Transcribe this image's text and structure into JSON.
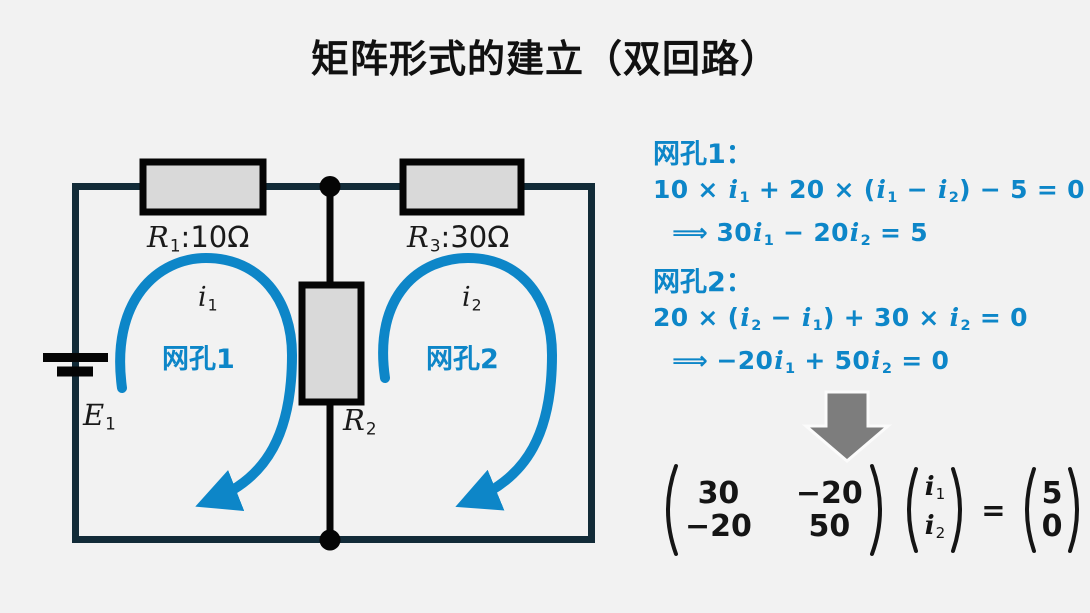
{
  "title": "矩阵形式的建立（双回路）",
  "colors": {
    "background": "#f2f2f2",
    "accent_blue": "#0d86c8",
    "wire_navy": "#122b38",
    "component_fill": "#d9d9d9",
    "ink_black": "#141414",
    "arrow_gray": "#7d7d7d"
  },
  "circuit": {
    "r1_label": [
      {
        "t": "R",
        "s": "rit"
      },
      {
        "t": "1",
        "s": "sub"
      },
      {
        "t": ":10Ω"
      }
    ],
    "r3_label": [
      {
        "t": "R",
        "s": "rit"
      },
      {
        "t": "3",
        "s": "sub"
      },
      {
        "t": ":30Ω"
      }
    ],
    "r2_label": [
      {
        "t": "R",
        "s": "rit"
      },
      {
        "t": "2",
        "s": "sub"
      }
    ],
    "e1_label": [
      {
        "t": "E",
        "s": "rit"
      },
      {
        "t": "1",
        "s": "sub"
      }
    ],
    "mesh1": {
      "current": [
        {
          "t": "i",
          "s": "rit"
        },
        {
          "t": "1",
          "s": "sub"
        }
      ],
      "name": "网孔1"
    },
    "mesh2": {
      "current": [
        {
          "t": "i",
          "s": "rit"
        },
        {
          "t": "2",
          "s": "sub"
        }
      ],
      "name": "网孔2"
    }
  },
  "equations": {
    "mesh1_header": "网孔1：",
    "mesh1_line1": [
      {
        "t": "10 × "
      },
      {
        "t": "i",
        "s": "it"
      },
      {
        "t": "1",
        "s": "sub"
      },
      {
        "t": " + 20 × ("
      },
      {
        "t": "i",
        "s": "it"
      },
      {
        "t": "1",
        "s": "sub"
      },
      {
        "t": " − "
      },
      {
        "t": "i",
        "s": "it"
      },
      {
        "t": "2",
        "s": "sub"
      },
      {
        "t": ") − 5 = 0"
      }
    ],
    "mesh1_line2": [
      {
        "t": "⟹  ",
        "s": "dbl"
      },
      {
        "t": "30"
      },
      {
        "t": "i",
        "s": "it"
      },
      {
        "t": "1",
        "s": "sub"
      },
      {
        "t": " − 20"
      },
      {
        "t": "i",
        "s": "it"
      },
      {
        "t": "2",
        "s": "sub"
      },
      {
        "t": " = 5"
      }
    ],
    "mesh2_header": "网孔2：",
    "mesh2_line1": [
      {
        "t": "20 × ("
      },
      {
        "t": "i",
        "s": "it"
      },
      {
        "t": "2",
        "s": "sub"
      },
      {
        "t": " − "
      },
      {
        "t": "i",
        "s": "it"
      },
      {
        "t": "1",
        "s": "sub"
      },
      {
        "t": ") + 30 × "
      },
      {
        "t": "i",
        "s": "it"
      },
      {
        "t": "2",
        "s": "sub"
      },
      {
        "t": " = 0"
      }
    ],
    "mesh2_line2": [
      {
        "t": "⟹  ",
        "s": "dbl"
      },
      {
        "t": "−20"
      },
      {
        "t": "i",
        "s": "it"
      },
      {
        "t": "1",
        "s": "sub"
      },
      {
        "t": " + 50"
      },
      {
        "t": "i",
        "s": "it"
      },
      {
        "t": "2",
        "s": "sub"
      },
      {
        "t": " = 0"
      }
    ]
  },
  "matrix": {
    "a": [
      [
        "30",
        "−20"
      ],
      [
        "−20",
        "50"
      ]
    ],
    "x": [
      [
        {
          "t": "i",
          "s": "it"
        },
        {
          "t": "1",
          "s": "sub"
        }
      ],
      [
        {
          "t": "i",
          "s": "it"
        },
        {
          "t": "2",
          "s": "sub"
        }
      ]
    ],
    "equals": "=",
    "b": [
      "5",
      "0"
    ]
  }
}
